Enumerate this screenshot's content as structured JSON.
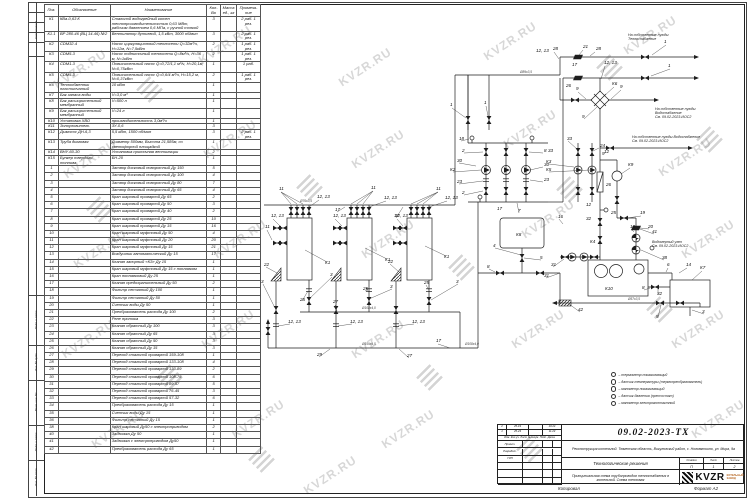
{
  "watermark": "KVZR.RU",
  "side_stamps": {
    "top": "Согласовано",
    "bottom": [
      "Подп. и дата",
      "Инв. № дубл.",
      "Взам. инв. №",
      "Подп. и дата",
      "Инв. № подл."
    ]
  },
  "spec_table": {
    "headers": [
      "Поз.",
      "Обозначение",
      "Наименование",
      "Кол-Во",
      "Масса ед., кг",
      "Примеча- ние"
    ],
    "rows": [
      [
        "К1",
        "КВа-0,63 К",
        "Стальной водогрейный котел теплопроизводительностью 0,63 МВт, рабочим давлением 0,6 МПа, с ручной топкой",
        "3",
        "",
        "2 раб. 1 рез."
      ],
      [
        "К1.1",
        "ВР 280-46 (ВЦ 14-46) №2",
        "Вентилятор дутьевой, 1,5 кВт, 3000 об/мин",
        "3",
        "",
        "2 раб. 1 рез."
      ],
      [
        "К2",
        "CDM32-4",
        "Насос циркуляционный теплосети Q=32м³/ч, Н=12м, N=7,5кВт",
        "2",
        "",
        "1 раб. 1 рез."
      ],
      [
        "К3",
        "CDM5-3",
        "Насос подпиточный теплосети Q=8м³/ч, Н=36 м, N=1кВт",
        "2",
        "",
        "1 раб. 1 рез."
      ],
      [
        "К4",
        "CDM1-3",
        "Повысительный насос Q=0,72/1,1 м³/ч, Н=20,1м, N=0,75кВт",
        "1",
        "",
        "1 раб."
      ],
      [
        "К5",
        "CDM5-3",
        "Повысительный насос Q=0,6/4 м³/ч, Н=15,2 м, N=0,37кВт",
        "2",
        "",
        "1 раб. 1 рез."
      ],
      [
        "К6",
        "Теплообменник пластинчатый",
        "10 кВт",
        "1",
        "",
        ""
      ],
      [
        "К7",
        "Бак запаса воды",
        "V=3,0 м³",
        "1",
        "",
        ""
      ],
      [
        "К8",
        "Бак расширительный мембранный",
        "V=500 л",
        "1",
        "",
        ""
      ],
      [
        "К9",
        "Бак расширительный мембранный",
        "V=24 л",
        "1",
        "",
        ""
      ],
      [
        "К10",
        "Установка ХВО",
        "производительность 3,0м³/ч",
        "1",
        "",
        ""
      ],
      [
        "К11",
        "Золоуловитель",
        "ЗУ-0,6",
        "3",
        "",
        ""
      ],
      [
        "К12",
        "Дымосос ДН-6,3",
        "5,5 кВт, 1500 об/мин",
        "3",
        "",
        "2 раб. 1 рез."
      ],
      [
        "К13",
        "Труба дымовая",
        "Диаметр 500мм, Высота 21,585м, со светофорной площадкой",
        "1",
        "",
        ""
      ],
      [
        "К14",
        "ВНУ-60-30",
        "Установка приточная вентиляции",
        "2",
        "",
        ""
      ],
      [
        "К15",
        "Бункер твердого топлива",
        "БН-20",
        "1",
        "",
        ""
      ],
      [
        "1",
        "",
        "Затвор дисковый поворотный Ду 150",
        "5",
        "",
        ""
      ],
      [
        "2",
        "",
        "Затвор дисковый поворотный Ду 100",
        "4",
        "",
        ""
      ],
      [
        "3",
        "",
        "Затвор дисковый поворотный Ду 80",
        "7",
        "",
        ""
      ],
      [
        "4",
        "",
        "Затвор дисковый поворотный Ду 65",
        "4",
        "",
        ""
      ],
      [
        "5",
        "",
        "Кран шаровый приварной Ду 65",
        "2",
        "",
        ""
      ],
      [
        "6",
        "",
        "Кран шаровый приварной Ду 50",
        "3",
        "",
        ""
      ],
      [
        "7",
        "",
        "Кран шаровый приварной Ду 40",
        "2",
        "",
        ""
      ],
      [
        "8",
        "",
        "Кран шаровый приварной Ду 25",
        "10",
        "",
        ""
      ],
      [
        "9",
        "",
        "Кран шаровый приварной Ду 15",
        "16",
        "",
        ""
      ],
      [
        "10",
        "",
        "Кран шаровый муфтовый Ду 50",
        "4",
        "",
        ""
      ],
      [
        "11",
        "",
        "Кран шаровый муфтовый Ду 20",
        "20",
        "",
        ""
      ],
      [
        "12",
        "",
        "Кран шаровый муфтовый Ду 15",
        "21",
        "",
        ""
      ],
      [
        "13",
        "",
        "Воздушник автоматический Ду 15",
        "17",
        "",
        ""
      ],
      [
        "14",
        "",
        "Клапан запорный «КЗ» Ду 15",
        "1",
        "",
        ""
      ],
      [
        "15",
        "",
        "Кран шаровый муфтовый Ду 15 с поплавком",
        "1",
        "",
        ""
      ],
      [
        "16",
        "",
        "Кран поплавковый Ду 25",
        "1",
        "",
        ""
      ],
      [
        "17",
        "",
        "Клапан предохранительный Ду 50",
        "2",
        "",
        ""
      ],
      [
        "18",
        "",
        "Фильтр сетчатый Ду 100",
        "1",
        "",
        ""
      ],
      [
        "19",
        "",
        "Фильтр сетчатый Ду 50",
        "1",
        "",
        ""
      ],
      [
        "20",
        "",
        "Счетчик воды Ду 50",
        "1",
        "",
        ""
      ],
      [
        "21",
        "",
        "Преобразователь расхода Ду 100",
        "2",
        "",
        ""
      ],
      [
        "22",
        "",
        "Реле протока",
        "3",
        "",
        ""
      ],
      [
        "23",
        "",
        "Клапан обратный Ду 100",
        "3",
        "",
        ""
      ],
      [
        "24",
        "",
        "Клапан обратный Ду 65",
        "3",
        "",
        ""
      ],
      [
        "25",
        "",
        "Клапан обратный Ду 50",
        "3",
        "",
        ""
      ],
      [
        "26",
        "",
        "Клапан обратный Ду 15",
        "3",
        "",
        ""
      ],
      [
        "27",
        "",
        "Переход стальной приварной 159-108",
        "1",
        "",
        ""
      ],
      [
        "28",
        "",
        "Переход стальной приварной 133-108",
        "4",
        "",
        ""
      ],
      [
        "29",
        "",
        "Переход стальной приварной 133-89",
        "2",
        "",
        ""
      ],
      [
        "30",
        "",
        "Переход стальной приварной 108-76",
        "6",
        "",
        ""
      ],
      [
        "31",
        "",
        "Переход стальной приварной 89-57",
        "5",
        "",
        ""
      ],
      [
        "32",
        "",
        "Переход стальной приварной 76-45",
        "3",
        "",
        ""
      ],
      [
        "33",
        "",
        "Переход стальной приварной 57-32",
        "6",
        "",
        ""
      ],
      [
        "34",
        "",
        "Преобразователь расхода Ду 15",
        "1",
        "",
        ""
      ],
      [
        "35",
        "",
        "Счетчик воды Ду 15",
        "1",
        "",
        ""
      ],
      [
        "36",
        "",
        "Фильтр сетчатый Ду 15",
        "1",
        "",
        ""
      ],
      [
        "38",
        "",
        "Кран шаровый Ду50 с электроприводом",
        "2",
        "",
        ""
      ],
      [
        "40",
        "",
        "Задвижка Ду 50",
        "1",
        "",
        ""
      ],
      [
        "41",
        "",
        "Задвижка с электроприводом Ду50",
        "1",
        "",
        ""
      ],
      [
        "42",
        "",
        "Преобразователь расхода Ду 65",
        "1",
        "",
        ""
      ]
    ]
  },
  "schematic": {
    "callouts": [
      [
        536,
        52,
        "12, 13"
      ],
      [
        553,
        50,
        "28"
      ],
      [
        583,
        48,
        "21"
      ],
      [
        596,
        50,
        "28"
      ],
      [
        664,
        43,
        "1"
      ],
      [
        572,
        66,
        "17"
      ],
      [
        668,
        67,
        "1"
      ],
      [
        566,
        87,
        "26"
      ],
      [
        450,
        106,
        "1"
      ],
      [
        484,
        104,
        "1"
      ],
      [
        604,
        64,
        "12, 13"
      ],
      [
        612,
        85,
        "К6"
      ],
      [
        576,
        90,
        "9"
      ],
      [
        620,
        88,
        "9"
      ],
      [
        582,
        118,
        "9"
      ],
      [
        567,
        140,
        "33"
      ],
      [
        604,
        153,
        "12"
      ],
      [
        628,
        166,
        "К9"
      ],
      [
        606,
        186,
        "26"
      ],
      [
        548,
        152,
        "33"
      ],
      [
        546,
        163,
        "К3"
      ],
      [
        546,
        171,
        "К5"
      ],
      [
        600,
        147,
        "24"
      ],
      [
        602,
        155,
        "9"
      ],
      [
        459,
        140,
        "18"
      ],
      [
        462,
        152,
        "2"
      ],
      [
        457,
        162,
        "30"
      ],
      [
        450,
        171,
        "К2"
      ],
      [
        457,
        183,
        "23"
      ],
      [
        462,
        194,
        "2"
      ],
      [
        544,
        152,
        "8"
      ],
      [
        544,
        166,
        "30"
      ],
      [
        544,
        181,
        "23"
      ],
      [
        497,
        210,
        "17"
      ],
      [
        518,
        212,
        "7"
      ],
      [
        558,
        218,
        "16"
      ],
      [
        516,
        236,
        "К8"
      ],
      [
        493,
        247,
        "4"
      ],
      [
        540,
        259,
        "5"
      ],
      [
        487,
        268,
        "8"
      ],
      [
        590,
        243,
        "К4"
      ],
      [
        551,
        266,
        "31"
      ],
      [
        544,
        277,
        "31"
      ],
      [
        586,
        206,
        "12"
      ],
      [
        611,
        214,
        "25"
      ],
      [
        586,
        220,
        "32"
      ],
      [
        640,
        214,
        "19"
      ],
      [
        648,
        228,
        "20"
      ],
      [
        630,
        228,
        "10"
      ],
      [
        652,
        233,
        "41"
      ],
      [
        662,
        259,
        "38"
      ],
      [
        605,
        290,
        "К10"
      ],
      [
        700,
        269,
        "К7"
      ],
      [
        667,
        266,
        "6"
      ],
      [
        686,
        266,
        "14"
      ],
      [
        642,
        289,
        "8"
      ],
      [
        657,
        295,
        "32"
      ],
      [
        702,
        313,
        "3"
      ],
      [
        656,
        318,
        "5"
      ],
      [
        578,
        311,
        "42"
      ],
      [
        279,
        190,
        "11"
      ],
      [
        317,
        198,
        "12, 13"
      ],
      [
        371,
        189,
        "11"
      ],
      [
        384,
        199,
        "12, 13"
      ],
      [
        436,
        190,
        "11"
      ],
      [
        445,
        199,
        "12, 13"
      ],
      [
        335,
        211,
        "17"
      ],
      [
        394,
        217,
        "17"
      ],
      [
        271,
        217,
        "12, 13"
      ],
      [
        265,
        228,
        "11"
      ],
      [
        333,
        217,
        "12, 13"
      ],
      [
        395,
        217,
        "12, 13"
      ],
      [
        325,
        264,
        "К1"
      ],
      [
        385,
        261,
        "К1"
      ],
      [
        444,
        258,
        "К1"
      ],
      [
        264,
        266,
        "22"
      ],
      [
        388,
        263,
        "22"
      ],
      [
        261,
        283,
        "3"
      ],
      [
        330,
        276,
        "3"
      ],
      [
        390,
        288,
        "3"
      ],
      [
        456,
        283,
        "3"
      ],
      [
        300,
        301,
        "25"
      ],
      [
        363,
        290,
        "25"
      ],
      [
        424,
        284,
        "25"
      ],
      [
        333,
        303,
        "27"
      ],
      [
        288,
        323,
        "12, 13"
      ],
      [
        350,
        323,
        "12, 13"
      ],
      [
        412,
        323,
        "12, 13"
      ],
      [
        317,
        356,
        "29"
      ],
      [
        407,
        357,
        "27"
      ],
      [
        436,
        342,
        "17"
      ]
    ],
    "dims": [
      [
        362,
        345,
        "Ø159х4,5"
      ],
      [
        362,
        309,
        "Ø108х4,0"
      ],
      [
        300,
        202,
        "Ø76х3,5"
      ],
      [
        628,
        300,
        "Ø57х3,5"
      ],
      [
        520,
        73,
        "Ø89х3,5"
      ],
      [
        465,
        345,
        "Ø108х4,0"
      ]
    ],
    "notes": [
      {
        "x": 628,
        "y": 36,
        "lines": [
          "На собственные нужды",
          "Теплоснабжение"
        ]
      },
      {
        "x": 655,
        "y": 110,
        "lines": [
          "На собственные нужды",
          "Водоснабжение",
          "См. 09.02-2023-ИОС2"
        ]
      },
      {
        "x": 632,
        "y": 138,
        "lines": [
          "На собственные нужды  Водоснабжение",
          "См. 09.02-2023-ИОС2"
        ]
      },
      {
        "x": 652,
        "y": 243,
        "lines": [
          "Водомерный узел",
          "См. 09.02-2023-ИОС2"
        ]
      }
    ]
  },
  "legend": {
    "items": [
      "–  термометр показывающий",
      "–  датчик температуры (термопреобразователь)",
      "–  манометр показывающий",
      "–  датчик давления (прессостат)",
      "–  манометр электроконтактный"
    ]
  },
  "title_block": {
    "doc_number": "09.02-2023-ТХ",
    "project_name": "Реконструкция котельной. Тюменская область, Викуловский район, с. Нововяткино, ул. Мира, 9а",
    "section": "Технологические решения",
    "sheet_title": "Принципиальная схема трубопроводов теплоснабжения в котельной. Схема тепловая",
    "stage_label": "Стадия",
    "stage": "П",
    "sheet_label": "Лист",
    "sheet": "1",
    "sheets_label": "Листов",
    "sheets": "2",
    "rev_header": "Изм. Кол.уч. Лист №докум. Подп. Дата",
    "revisions": [
      {
        "num": "2",
        "doc": "25-19",
        "sign": "",
        "date": "10.24"
      },
      {
        "num": "1",
        "doc": "25-23",
        "sign": "",
        "date": "11.23"
      }
    ],
    "roles": [
      "Проект.",
      "Разработ.",
      "ГИП"
    ],
    "logo_text": "KVZR",
    "logo_sub1": "КОТЕЛЬНЫЙ",
    "logo_sub2": "ЗАВОД",
    "copied_label": "Копировал",
    "format_label": "Формат А2"
  }
}
